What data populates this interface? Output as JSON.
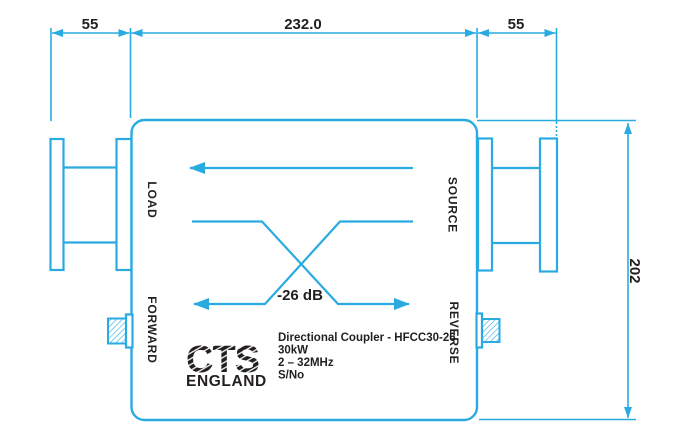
{
  "drawing": {
    "type": "engineering-dimension-drawing",
    "subject": "RF directional coupler outline drawing"
  },
  "dimensions": {
    "left_flange_width": "55",
    "body_width": "232.0",
    "right_flange_width": "55",
    "body_height": "202"
  },
  "ports": {
    "load": "LOAD",
    "source": "SOURCE",
    "forward": "FORWARD",
    "reverse": "REVERSE"
  },
  "coupler": {
    "coupling_value": "-26 dB"
  },
  "nameplate": {
    "logo_text": "CTS",
    "logo_subtext": "ENGLAND",
    "line1": "Directional Coupler - HFCC30-26",
    "line2": "30kW",
    "line3": "2 – 32MHz",
    "line4": "S/No"
  },
  "colors": {
    "line": "#29ABE2",
    "ink": "#231F20",
    "background": "#FFFFFF"
  }
}
